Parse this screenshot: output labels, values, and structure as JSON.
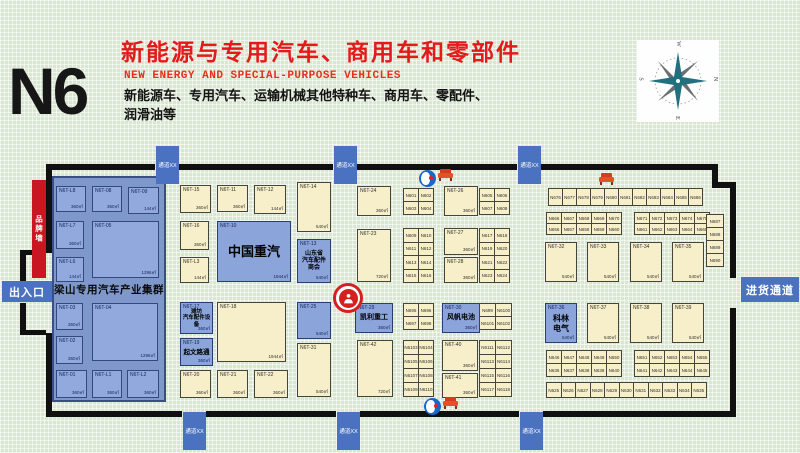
{
  "header": {
    "hall": "N6",
    "title": "新能源与专用汽车、商用车和零部件",
    "subtitle_en": "NEW ENERGY AND SPECIAL-PURPOSE VEHICLES",
    "description": "新能源车、专用汽车、运输机械其他特种车、商用车、零配件、\n润滑油等"
  },
  "colors": {
    "title_red": "#e31a1a",
    "booth_cream": "#f6efca",
    "booth_blue": "#8ba4d9",
    "cluster_panel": "#7f98cb",
    "passage_blue": "#4a72c0",
    "brand_wall_red": "#c81622",
    "wall_black": "#101010",
    "background_green": "#d9e6d0"
  },
  "compass": {
    "letters": {
      "top": "W",
      "right": "N",
      "bottom": "E",
      "left": "S"
    }
  },
  "entrances": {
    "exit_entry": "出入口",
    "goods": "进货通道",
    "passage_label": "通道XX",
    "brand_wall": "品牌墙"
  },
  "cluster": {
    "label": "梁山专用汽车产业集群",
    "rect": [
      52,
      176,
      114,
      226
    ],
    "label_y": 282
  },
  "walls": [
    [
      46,
      164,
      109,
      6
    ],
    [
      179,
      164,
      154,
      6
    ],
    [
      357,
      164,
      160,
      6
    ],
    [
      541,
      164,
      171,
      6
    ],
    [
      712,
      164,
      6,
      24
    ],
    [
      712,
      182,
      24,
      6
    ],
    [
      730,
      182,
      6,
      96
    ],
    [
      730,
      308,
      6,
      109
    ],
    [
      46,
      411,
      136,
      6
    ],
    [
      206,
      411,
      130,
      6
    ],
    [
      360,
      411,
      159,
      6
    ],
    [
      543,
      411,
      193,
      6
    ],
    [
      46,
      164,
      6,
      89
    ],
    [
      46,
      333,
      6,
      84
    ],
    [
      20,
      250,
      26,
      5
    ],
    [
      20,
      250,
      6,
      36
    ],
    [
      20,
      303,
      6,
      32
    ],
    [
      20,
      330,
      26,
      5
    ]
  ],
  "passages": [
    {
      "x": 156,
      "y": 146
    },
    {
      "x": 334,
      "y": 146
    },
    {
      "x": 518,
      "y": 146
    },
    {
      "x": 183,
      "y": 412
    },
    {
      "x": 337,
      "y": 412
    },
    {
      "x": 520,
      "y": 412
    }
  ],
  "gates": {
    "exit_entry_rect": [
      2,
      281,
      50,
      21
    ],
    "goods_rect": [
      741,
      277,
      58,
      25
    ],
    "brand_wall_rect": [
      32,
      180,
      14,
      98
    ]
  },
  "booths": {
    "special": [
      {
        "c": "N6T-L8",
        "a": "360㎡",
        "t": "p",
        "x": 56,
        "y": 186,
        "w": 30,
        "h": 26
      },
      {
        "c": "N6T-08",
        "a": "360㎡",
        "t": "p",
        "x": 92,
        "y": 186,
        "w": 30,
        "h": 26
      },
      {
        "c": "N6T-09",
        "a": "144㎡",
        "t": "p",
        "x": 128,
        "y": 187,
        "w": 31,
        "h": 27
      },
      {
        "c": "N6T-L7",
        "a": "360㎡",
        "t": "p",
        "x": 56,
        "y": 221,
        "w": 28,
        "h": 28
      },
      {
        "c": "N6T-05",
        "a": "1296㎡",
        "t": "p",
        "x": 92,
        "y": 221,
        "w": 67,
        "h": 57
      },
      {
        "c": "N6T-L6",
        "a": "144㎡",
        "t": "p",
        "x": 56,
        "y": 257,
        "w": 28,
        "h": 25
      },
      {
        "c": "N6T-03",
        "a": "360㎡",
        "t": "p",
        "x": 56,
        "y": 303,
        "w": 27,
        "h": 27
      },
      {
        "c": "N6T-04",
        "a": "1296㎡",
        "t": "p",
        "x": 92,
        "y": 303,
        "w": 66,
        "h": 58
      },
      {
        "c": "N6T-02",
        "a": "360㎡",
        "t": "p",
        "x": 56,
        "y": 336,
        "w": 27,
        "h": 28
      },
      {
        "c": "N6T-01",
        "a": "360㎡",
        "t": "p",
        "x": 56,
        "y": 370,
        "w": 31,
        "h": 28
      },
      {
        "c": "N6T-L1",
        "a": "360㎡",
        "t": "p",
        "x": 92,
        "y": 370,
        "w": 30,
        "h": 28
      },
      {
        "c": "N6T-L2",
        "a": "360㎡",
        "t": "p",
        "x": 127,
        "y": 370,
        "w": 32,
        "h": 28
      },
      {
        "c": "N6T-15",
        "a": "360㎡",
        "t": "c",
        "x": 180,
        "y": 185,
        "w": 31,
        "h": 28
      },
      {
        "c": "N6T-11",
        "a": "360㎡",
        "t": "c",
        "x": 217,
        "y": 185,
        "w": 31,
        "h": 27
      },
      {
        "c": "N6T-12",
        "a": "144㎡",
        "t": "c",
        "x": 254,
        "y": 185,
        "w": 32,
        "h": 29
      },
      {
        "c": "N6T-14",
        "a": "540㎡",
        "t": "c",
        "x": 297,
        "y": 182,
        "w": 34,
        "h": 50
      },
      {
        "c": "N6T-16",
        "a": "360㎡",
        "t": "c",
        "x": 180,
        "y": 221,
        "w": 29,
        "h": 29
      },
      {
        "c": "N6T-10",
        "a": "1944㎡",
        "t": "b",
        "x": 217,
        "y": 221,
        "w": 74,
        "h": 61,
        "l": "中国重汽",
        "ls": 13
      },
      {
        "c": "N6T-L3",
        "a": "144㎡",
        "t": "c",
        "x": 180,
        "y": 257,
        "w": 29,
        "h": 26
      },
      {
        "c": "N6T-13",
        "a": "540㎡",
        "t": "b",
        "x": 297,
        "y": 239,
        "w": 34,
        "h": 44,
        "l": "山东省\n汽车配件\n商会",
        "ls": 6
      },
      {
        "c": "N6T-17",
        "a": "360㎡",
        "t": "b",
        "x": 180,
        "y": 302,
        "w": 33,
        "h": 32,
        "l": "潍坊\n汽车配件设备",
        "ls": 5.5
      },
      {
        "c": "N6T-19",
        "a": "360㎡",
        "t": "b",
        "x": 180,
        "y": 338,
        "w": 33,
        "h": 28,
        "l": "起文路通",
        "ls": 6.5
      },
      {
        "c": "N6T-18",
        "a": "1944㎡",
        "t": "c",
        "x": 217,
        "y": 302,
        "w": 69,
        "h": 60
      },
      {
        "c": "N6T-25",
        "a": "540㎡",
        "t": "b",
        "x": 297,
        "y": 302,
        "w": 34,
        "h": 37
      },
      {
        "c": "N6T-31",
        "a": "540㎡",
        "t": "c",
        "x": 297,
        "y": 343,
        "w": 34,
        "h": 54
      },
      {
        "c": "N6T-20",
        "a": "360㎡",
        "t": "c",
        "x": 180,
        "y": 370,
        "w": 31,
        "h": 28
      },
      {
        "c": "N6T-21",
        "a": "360㎡",
        "t": "c",
        "x": 217,
        "y": 370,
        "w": 31,
        "h": 28
      },
      {
        "c": "N6T-22",
        "a": "360㎡",
        "t": "c",
        "x": 254,
        "y": 370,
        "w": 34,
        "h": 28
      },
      {
        "c": "N6T-24",
        "a": "360㎡",
        "t": "c",
        "x": 357,
        "y": 186,
        "w": 34,
        "h": 30
      },
      {
        "c": "N6T-26",
        "a": "360㎡",
        "t": "c",
        "x": 444,
        "y": 186,
        "w": 34,
        "h": 30
      },
      {
        "c": "N6T-23",
        "a": "720㎡",
        "t": "c",
        "x": 357,
        "y": 229,
        "w": 34,
        "h": 53
      },
      {
        "c": "N6T-27",
        "a": "360㎡",
        "t": "c",
        "x": 444,
        "y": 228,
        "w": 34,
        "h": 27
      },
      {
        "c": "N6T-28",
        "a": "360㎡",
        "t": "c",
        "x": 444,
        "y": 257,
        "w": 34,
        "h": 26
      },
      {
        "c": "N6T-29",
        "a": "360㎡",
        "t": "b",
        "x": 355,
        "y": 303,
        "w": 38,
        "h": 30,
        "l": "凯利重工",
        "ls": 7
      },
      {
        "c": "N6T-30",
        "a": "360㎡",
        "t": "b",
        "x": 442,
        "y": 303,
        "w": 38,
        "h": 30,
        "l": "风帆电池",
        "ls": 7
      },
      {
        "c": "N6T-42",
        "a": "720㎡",
        "t": "c",
        "x": 357,
        "y": 340,
        "w": 36,
        "h": 57
      },
      {
        "c": "N6T-40",
        "a": "360㎡",
        "t": "c",
        "x": 442,
        "y": 340,
        "w": 36,
        "h": 31
      },
      {
        "c": "N6T-41",
        "a": "360㎡",
        "t": "c",
        "x": 442,
        "y": 373,
        "w": 36,
        "h": 25
      },
      {
        "c": "N6T-32",
        "a": "540㎡",
        "t": "c",
        "x": 545,
        "y": 242,
        "w": 32,
        "h": 40
      },
      {
        "c": "N6T-33",
        "a": "540㎡",
        "t": "c",
        "x": 587,
        "y": 242,
        "w": 32,
        "h": 40
      },
      {
        "c": "N6T-34",
        "a": "540㎡",
        "t": "c",
        "x": 630,
        "y": 242,
        "w": 32,
        "h": 40
      },
      {
        "c": "N6T-35",
        "a": "540㎡",
        "t": "c",
        "x": 672,
        "y": 242,
        "w": 32,
        "h": 40
      },
      {
        "c": "N6T-36",
        "a": "540㎡",
        "t": "b",
        "x": 545,
        "y": 303,
        "w": 32,
        "h": 40,
        "l": "科林\n电气",
        "ls": 8
      },
      {
        "c": "N6T-37",
        "a": "540㎡",
        "t": "c",
        "x": 587,
        "y": 303,
        "w": 32,
        "h": 40
      },
      {
        "c": "N6T-38",
        "a": "540㎡",
        "t": "c",
        "x": 630,
        "y": 303,
        "w": 32,
        "h": 40
      },
      {
        "c": "N6T-39",
        "a": "540㎡",
        "t": "c",
        "x": 672,
        "y": 303,
        "w": 32,
        "h": 40
      }
    ],
    "grids": [
      {
        "x": 403,
        "y": 188,
        "cols": 2,
        "cw": 15,
        "ch": 13,
        "labels": [
          "N601",
          "N602",
          "N603",
          "N604"
        ]
      },
      {
        "x": 479,
        "y": 188,
        "cols": 2,
        "cw": 15,
        "ch": 13,
        "labels": [
          "N605",
          "N606",
          "N607",
          "N608"
        ]
      },
      {
        "x": 403,
        "y": 228,
        "cols": 2,
        "cw": 15,
        "ch": 13.5,
        "labels": [
          "N609",
          "N610",
          "N611",
          "N612",
          "N613",
          "N614",
          "N615",
          "N616"
        ]
      },
      {
        "x": 479,
        "y": 228,
        "cols": 2,
        "cw": 15,
        "ch": 13.5,
        "labels": [
          "N617",
          "N618",
          "N619",
          "N620",
          "N621",
          "N622",
          "N623",
          "N624"
        ]
      },
      {
        "x": 403,
        "y": 303,
        "cols": 2,
        "cw": 15,
        "ch": 13,
        "labels": [
          "N695",
          "N696",
          "N697",
          "N698"
        ]
      },
      {
        "x": 479,
        "y": 303,
        "cols": 2,
        "cw": 16,
        "ch": 13,
        "labels": [
          "N699",
          "N6100",
          "N6101",
          "N6102"
        ]
      },
      {
        "x": 403,
        "y": 340,
        "cols": 2,
        "cw": 15,
        "ch": 14,
        "labels": [
          "N6103",
          "N6104",
          "N6105",
          "N6106",
          "N6107",
          "N6108",
          "N6109",
          "N6110"
        ]
      },
      {
        "x": 479,
        "y": 340,
        "cols": 2,
        "cw": 16,
        "ch": 14,
        "labels": [
          "N6111",
          "N6112",
          "N6113",
          "N6114",
          "N6115",
          "N6116",
          "N6117",
          "N6118"
        ]
      },
      {
        "x": 548,
        "y": 188,
        "cols": 11,
        "cw": 14,
        "ch": 17,
        "labels": [
          "N676",
          "N677",
          "N678",
          "N679",
          "N680",
          "N681",
          "N682",
          "N683",
          "N684",
          "N685",
          "N686"
        ]
      },
      {
        "x": 546,
        "y": 212,
        "cols": 5,
        "cw": 15,
        "ch": 11,
        "labels": [
          "N666",
          "N667",
          "N668",
          "N669",
          "N670",
          "N656",
          "N657",
          "N658",
          "N659",
          "N660"
        ]
      },
      {
        "x": 634,
        "y": 212,
        "cols": 5,
        "cw": 15,
        "ch": 11,
        "labels": [
          "N671",
          "N672",
          "N673",
          "N674",
          "N675",
          "N661",
          "N662",
          "N663",
          "N664",
          "N665"
        ]
      },
      {
        "x": 706,
        "y": 214,
        "cols": 1,
        "cw": 17,
        "ch": 13,
        "labels": [
          "N687",
          "N688",
          "N689",
          "N690"
        ]
      },
      {
        "x": 546,
        "y": 350,
        "cols": 5,
        "cw": 15,
        "ch": 13,
        "labels": [
          "N646",
          "N647",
          "N648",
          "N649",
          "N650",
          "N636",
          "N637",
          "N638",
          "N639",
          "N640"
        ]
      },
      {
        "x": 634,
        "y": 350,
        "cols": 5,
        "cw": 15,
        "ch": 13,
        "labels": [
          "N651",
          "N652",
          "N653",
          "N654",
          "N655",
          "N641",
          "N642",
          "N643",
          "N644",
          "N645"
        ]
      },
      {
        "x": 546,
        "y": 382,
        "cols": 11,
        "cw": 14.5,
        "ch": 15,
        "labels": [
          "N625",
          "N626",
          "N627",
          "N628",
          "N629",
          "N630",
          "N631",
          "N632",
          "N633",
          "N634",
          "N635"
        ]
      }
    ]
  },
  "icons": [
    {
      "type": "wc",
      "x": 419,
      "y": 170
    },
    {
      "type": "sofa",
      "x": 437,
      "y": 168
    },
    {
      "type": "sofa",
      "x": 598,
      "y": 172
    },
    {
      "type": "wc",
      "x": 424,
      "y": 398
    },
    {
      "type": "sofa",
      "x": 442,
      "y": 396
    },
    {
      "type": "person",
      "x": 333,
      "y": 283
    }
  ]
}
